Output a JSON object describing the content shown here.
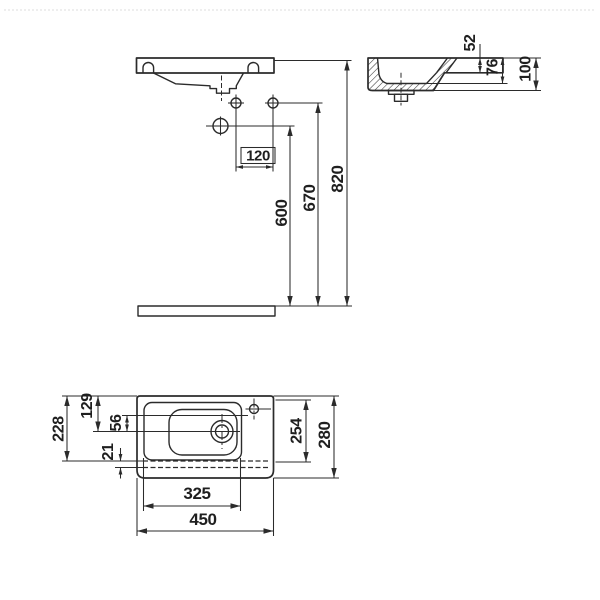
{
  "drawing": {
    "type": "washbasin-technical-drawing",
    "front": {
      "hole_spacing": "120",
      "drain_trap_height": "600",
      "mount_hole_height": "670",
      "rim_height": "820"
    },
    "side": {
      "deck_thickness": "52",
      "bowl_depth": "76",
      "overall_depth": "100"
    },
    "plan": {
      "back_to_overflow": "228",
      "back_to_drain": "129",
      "faucet_to_drain": "56",
      "front_lip": "21",
      "inner_depth": "254",
      "overall_depth": "280",
      "inner_width": "325",
      "overall_width": "450"
    }
  },
  "colors": {
    "line": "#2b2b2b",
    "background": "#ffffff",
    "frame_dash": "#dcdcdc"
  }
}
